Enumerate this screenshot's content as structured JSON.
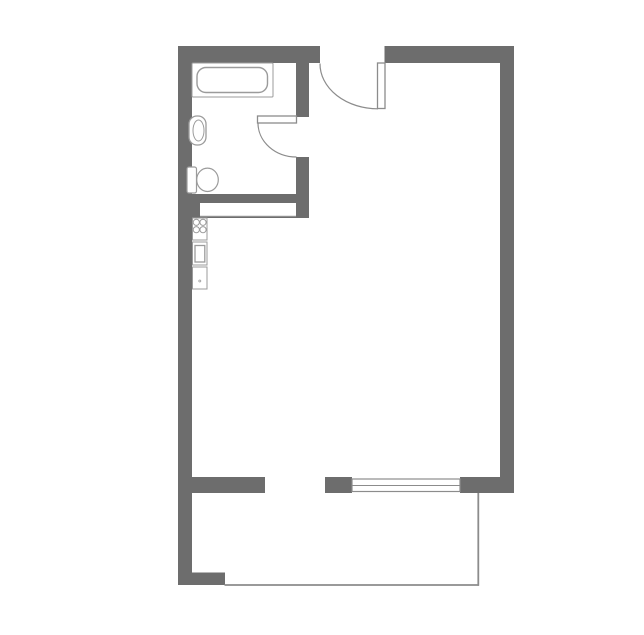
{
  "colors": {
    "paper": "#ffffff",
    "wall": "#6d6d6d",
    "outline": "#9b9b9b",
    "line": "#8c8c8c"
  },
  "plan": {
    "width": 644,
    "height": 635,
    "shapes": [
      {
        "name": "top-wall-left",
        "type": "rect",
        "x": 178,
        "y": 46,
        "w": 142,
        "h": 17,
        "fill": "wall",
        "stroke": "none"
      },
      {
        "name": "top-wall-right",
        "type": "rect",
        "x": 384.5,
        "y": 46,
        "w": 129.5,
        "h": 17,
        "fill": "wall",
        "stroke": "none"
      },
      {
        "name": "left-wall",
        "type": "rect",
        "x": 178,
        "y": 46,
        "w": 14,
        "h": 539,
        "fill": "wall",
        "stroke": "none"
      },
      {
        "name": "right-wall",
        "type": "rect",
        "x": 500,
        "y": 46,
        "w": 14,
        "h": 447,
        "fill": "wall",
        "stroke": "none"
      },
      {
        "name": "bathroom-wall-vertical-upper",
        "type": "rect",
        "x": 296,
        "y": 46,
        "w": 13,
        "h": 71,
        "fill": "wall",
        "stroke": "none"
      },
      {
        "name": "bathroom-wall-vertical-lower",
        "type": "rect",
        "x": 296,
        "y": 157,
        "w": 13,
        "h": 61,
        "fill": "wall",
        "stroke": "none"
      },
      {
        "name": "bathroom-wall-bottom",
        "type": "rect",
        "x": 192,
        "y": 194,
        "w": 117,
        "h": 24,
        "fill": "wall",
        "stroke": "none"
      },
      {
        "name": "bathroom-wall-pocket-opening",
        "type": "rect",
        "x": 200,
        "y": 203,
        "w": 96,
        "h": 13,
        "fill": "white",
        "stroke": "none"
      },
      {
        "name": "pocket-opening-sill-line",
        "type": "line",
        "x1": 200,
        "y1": 216.3,
        "x2": 296,
        "y2": 216.3,
        "fill": "none",
        "stroke": "outline",
        "sw": 1
      },
      {
        "name": "living-wall-bottom-left",
        "type": "rect",
        "x": 192,
        "y": 477,
        "w": 73,
        "h": 16,
        "fill": "wall",
        "stroke": "none"
      },
      {
        "name": "window-pier-left",
        "type": "rect",
        "x": 325,
        "y": 477,
        "w": 27,
        "h": 16,
        "fill": "wall",
        "stroke": "none"
      },
      {
        "name": "window-wall-right",
        "type": "rect",
        "x": 460,
        "y": 477,
        "w": 54,
        "h": 16,
        "fill": "wall",
        "stroke": "none"
      },
      {
        "name": "balcony-wall-stub",
        "type": "rect",
        "x": 192,
        "y": 572.5,
        "w": 33,
        "h": 12.5,
        "fill": "wall",
        "stroke": "none"
      },
      {
        "name": "window-frame",
        "type": "rect",
        "x": 352,
        "y": 479,
        "w": 108,
        "h": 12.5,
        "fill": "white",
        "stroke": "line",
        "sw": 1.2
      },
      {
        "name": "window-mullion-line",
        "type": "line",
        "x1": 352,
        "y1": 485.5,
        "x2": 460,
        "y2": 485.5,
        "fill": "none",
        "stroke": "line",
        "sw": 1
      },
      {
        "name": "balcony-rail-side",
        "type": "line",
        "x1": 478.3,
        "y1": 493,
        "x2": 478.3,
        "y2": 585.8,
        "fill": "none",
        "stroke": "line",
        "sw": 1.8
      },
      {
        "name": "balcony-rail-front",
        "type": "line",
        "x1": 224.5,
        "y1": 585,
        "x2": 479,
        "y2": 585,
        "fill": "none",
        "stroke": "line",
        "sw": 1.8
      },
      {
        "name": "entry-door-swing-arc",
        "type": "path",
        "d": "M 320 63.5 A 58 45 0 0 0 378 108.8",
        "fill": "none",
        "stroke": "line",
        "sw": 1.2
      },
      {
        "name": "entry-door-leaf",
        "type": "rect",
        "x": 377.5,
        "y": 63,
        "w": 7.5,
        "h": 45.5,
        "fill": "white",
        "stroke": "line",
        "sw": 1.3
      },
      {
        "name": "bathroom-door-swing-arc",
        "type": "path",
        "d": "M 258 123 A 38.5 34 0 0 0 296.5 157",
        "fill": "none",
        "stroke": "line",
        "sw": 1.2
      },
      {
        "name": "bathroom-door-leaf",
        "type": "rect",
        "x": 257.5,
        "y": 116,
        "w": 39,
        "h": 7,
        "fill": "white",
        "stroke": "line",
        "sw": 1.3
      },
      {
        "name": "bathtub-rim",
        "type": "rect",
        "x": 192,
        "y": 63,
        "w": 81,
        "h": 34,
        "rx": 1,
        "fill": "white",
        "stroke": "outline",
        "sw": 1
      },
      {
        "name": "bathtub-basin",
        "type": "rect",
        "x": 197,
        "y": 67.5,
        "w": 70.5,
        "h": 25,
        "rx": 9,
        "fill": "white",
        "stroke": "outline",
        "sw": 1.4
      },
      {
        "name": "sink-basin",
        "type": "rect",
        "x": 189,
        "y": 116,
        "w": 17,
        "h": 29,
        "rx": 8,
        "fill": "white",
        "stroke": "outline",
        "sw": 1.3
      },
      {
        "name": "sink-bowl",
        "type": "ellipse",
        "cx": 198.5,
        "cy": 130.5,
        "rx": 5.5,
        "ry": 10.5,
        "fill": "white",
        "stroke": "outline",
        "sw": 1
      },
      {
        "name": "toilet-tank",
        "type": "rect",
        "x": 187,
        "y": 167,
        "w": 9.5,
        "h": 26,
        "rx": 2,
        "fill": "white",
        "stroke": "outline",
        "sw": 1.2
      },
      {
        "name": "toilet-bowl",
        "type": "ellipse",
        "cx": 207.5,
        "cy": 179.8,
        "rx": 10.8,
        "ry": 11.7,
        "fill": "white",
        "stroke": "outline",
        "sw": 1.2
      },
      {
        "name": "stove",
        "type": "rect",
        "x": 192.5,
        "y": 218,
        "w": 14.5,
        "h": 22,
        "fill": "white",
        "stroke": "outline",
        "sw": 1
      },
      {
        "name": "stove-burner-1",
        "type": "circle",
        "cx": 196.3,
        "cy": 222.3,
        "r": 3.1,
        "fill": "white",
        "stroke": "outline",
        "sw": 1
      },
      {
        "name": "stove-burner-2",
        "type": "circle",
        "cx": 203,
        "cy": 222.3,
        "r": 3.1,
        "fill": "white",
        "stroke": "outline",
        "sw": 1
      },
      {
        "name": "stove-burner-3",
        "type": "circle",
        "cx": 196.3,
        "cy": 229.7,
        "r": 3.1,
        "fill": "white",
        "stroke": "outline",
        "sw": 1
      },
      {
        "name": "stove-burner-4",
        "type": "circle",
        "cx": 203,
        "cy": 229.7,
        "r": 3.1,
        "fill": "white",
        "stroke": "outline",
        "sw": 1
      },
      {
        "name": "kitchen-appliance",
        "type": "rect",
        "x": 192.5,
        "y": 242,
        "w": 14.5,
        "h": 23,
        "fill": "white",
        "stroke": "outline",
        "sw": 1
      },
      {
        "name": "kitchen-appliance-door",
        "type": "rect",
        "x": 195,
        "y": 245.5,
        "w": 9.8,
        "h": 16.5,
        "fill": "white",
        "stroke": "outline",
        "sw": 1.3
      },
      {
        "name": "kitchen-counter",
        "type": "rect",
        "x": 192.5,
        "y": 267,
        "w": 14.5,
        "h": 22,
        "fill": "white",
        "stroke": "outline",
        "sw": 1
      },
      {
        "name": "kitchen-counter-dot",
        "type": "circle",
        "cx": 199.8,
        "cy": 281,
        "r": 1,
        "fill": "none",
        "stroke": "outline",
        "sw": 0.8
      }
    ]
  }
}
